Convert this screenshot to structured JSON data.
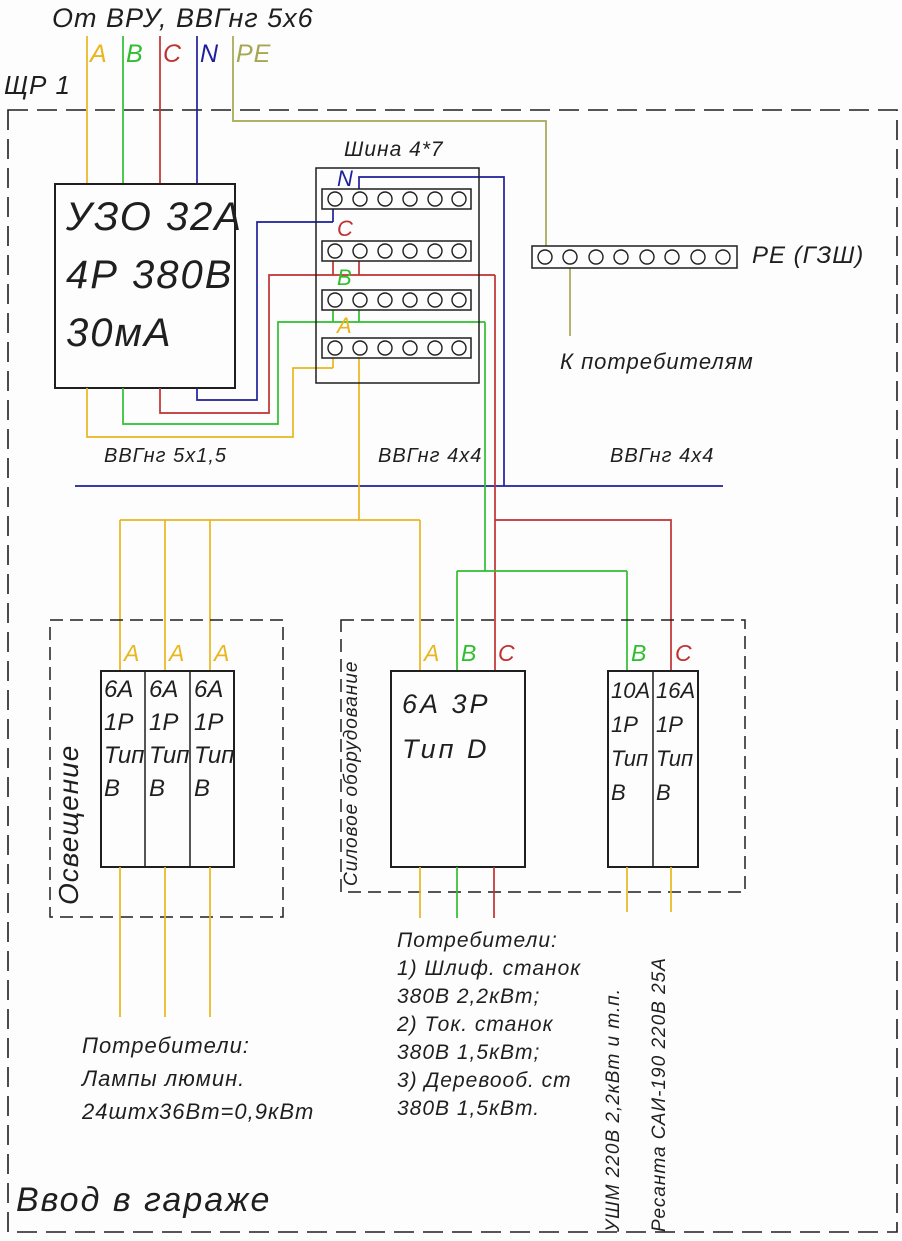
{
  "colors": {
    "phase-a": "#eab61e",
    "phase-b": "#2fbe2f",
    "phase-c": "#c03232",
    "neutral": "#1f1f99",
    "pe": "#a6a653",
    "ink": "#1f1f1f"
  },
  "header": {
    "supply_title": "От ВРУ, ВВГнг 5х6",
    "panel_name": "ЩР 1",
    "incoming_phase_labels": [
      "A",
      "B",
      "C",
      "N",
      "PE"
    ]
  },
  "rcd": {
    "lines": [
      "УЗО 32А",
      "4Р 380В",
      "30мА"
    ]
  },
  "busbar": {
    "title": "Шина 4*7",
    "strip_labels": [
      "N",
      "C",
      "B",
      "A"
    ],
    "holes_per_strip": 6
  },
  "pe_bus": {
    "label": "PE (ГЗШ)",
    "note": "К потребителям",
    "holes": 8
  },
  "cables": {
    "lighting": "ВВГнг 5х1,5",
    "power_3p": "ВВГнг 4х4",
    "power_1p": "ВВГнг 4х4"
  },
  "lighting_group": {
    "name": "Освещение",
    "phase_labels": [
      "A",
      "A",
      "A"
    ],
    "breakers": [
      {
        "lines": [
          "6А",
          "1Р",
          "Тип",
          "В"
        ]
      },
      {
        "lines": [
          "6А",
          "1Р",
          "Тип",
          "В"
        ]
      },
      {
        "lines": [
          "6А",
          "1Р",
          "Тип",
          "В"
        ]
      }
    ],
    "consumers": [
      "Потребители:",
      "Лампы люмин.",
      "24штх36Вт=0,9кВт"
    ]
  },
  "power_group": {
    "name": "Силовое оборудование",
    "breaker_3p": {
      "lines": [
        "6А 3Р",
        "Тип D"
      ],
      "phase_labels": [
        "A",
        "B",
        "C"
      ]
    },
    "breakers_1p": [
      {
        "lines": [
          "10А",
          "1Р",
          "Тип",
          "В"
        ],
        "phase_label": "B"
      },
      {
        "lines": [
          "16А",
          "1Р",
          "Тип",
          "В"
        ],
        "phase_label": "C"
      }
    ],
    "consumers": [
      "Потребители:",
      "1) Шлиф. станок",
      "380В 2,2кВт;",
      "2) Ток. станок",
      "380В 1,5кВт;",
      "3) Деревооб. ст",
      "380В 1,5кВт."
    ],
    "load_notes": [
      "УШМ 220В 2,2кВт и т.п.",
      "Ресанта САИ-190 220В 25А"
    ]
  },
  "footer": {
    "caption": "Ввод в гараже"
  }
}
